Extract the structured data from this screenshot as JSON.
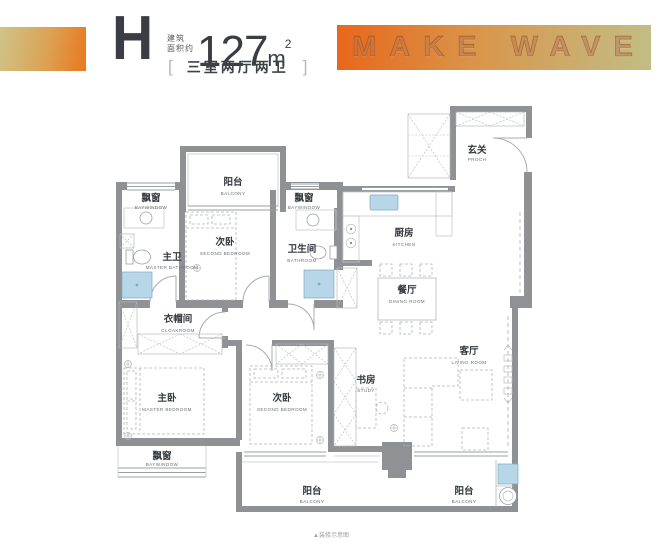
{
  "header": {
    "type_letter": "H",
    "area_prefix_line1": "建筑",
    "area_prefix_line2": "面积约",
    "area_number": "127",
    "area_unit": "m",
    "area_unit_sup": "2",
    "bracket_left": "[",
    "bracket_right": "]",
    "layout_text": "三室两厅两卫",
    "banner_text": "MAKE WAVE"
  },
  "colors": {
    "ink": "#3a3e44",
    "wall_gray": "#8f9194",
    "line_gray": "#9aa0a3",
    "fixture_blue": "#b7d7e8",
    "accent_orange": "#e8781f",
    "banner_gradient_start": "#e8671b",
    "banner_gradient_end": "#c2bd85"
  },
  "rooms": {
    "porch": {
      "zh": "玄关",
      "en": "PROCH"
    },
    "kitchen": {
      "zh": "厨房",
      "en": "KITCHEN"
    },
    "dining_room": {
      "zh": "餐厅",
      "en": "DINING ROOM"
    },
    "living_room": {
      "zh": "客厅",
      "en": "LIVING ROOM"
    },
    "study": {
      "zh": "书房",
      "en": "STUDY"
    },
    "second_bedroom_top": {
      "zh": "次卧",
      "en": "SECOND BEDROOM"
    },
    "bathroom": {
      "zh": "卫生间",
      "en": "BATHROOM"
    },
    "master_bathroom": {
      "zh": "主卫",
      "en": "MASTER BATHROOM"
    },
    "cloakroom": {
      "zh": "衣帽间",
      "en": "CLOAKROOM"
    },
    "master_bedroom": {
      "zh": "主卧",
      "en": "MASTER BEDROOM"
    },
    "second_bedroom_bottom": {
      "zh": "次卧",
      "en": "SECOND BEDROOM"
    },
    "balcony_top": {
      "zh": "阳台",
      "en": "BALCONY"
    },
    "balcony_bottom_left": {
      "zh": "阳台",
      "en": "BALCONY"
    },
    "balcony_bottom_right": {
      "zh": "阳台",
      "en": "BALCONY"
    },
    "baywindow_top_left": {
      "zh": "飘窗",
      "en": "BAYWINDOW"
    },
    "baywindow_top_middle": {
      "zh": "飘窗",
      "en": "BAYWINDOW"
    },
    "baywindow_bottom": {
      "zh": "飘窗",
      "en": "BAYWINDOW"
    }
  },
  "footnote": "▲装修示意图"
}
